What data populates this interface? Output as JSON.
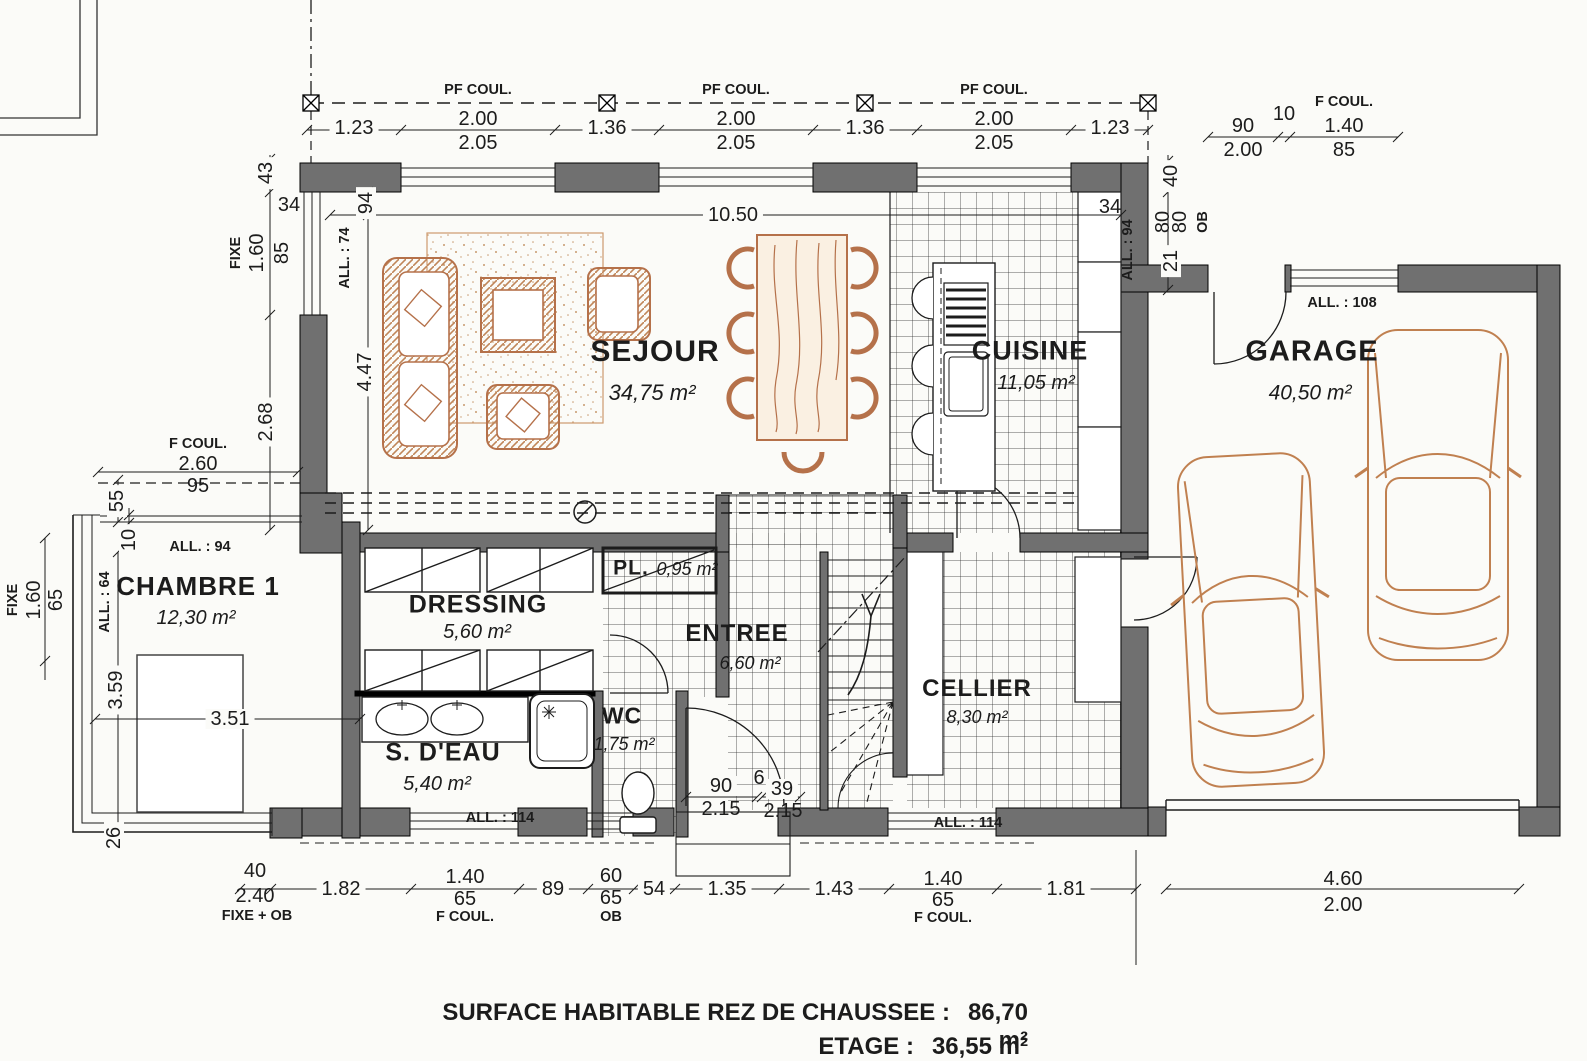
{
  "rooms": {
    "sejour": {
      "name": "SEJOUR",
      "area": "34,75 m²"
    },
    "cuisine": {
      "name": "CUISINE",
      "area": "11,05 m²"
    },
    "garage": {
      "name": "GARAGE",
      "area": "40,50 m²"
    },
    "chambre1": {
      "name": "CHAMBRE 1",
      "area": "12,30 m²"
    },
    "dressing": {
      "name": "DRESSING",
      "area": "5,60 m²"
    },
    "sdeau": {
      "name": "S. D'EAU",
      "area": "5,40 m²"
    },
    "wc": {
      "name": "WC",
      "area": "1,75 m²"
    },
    "entree": {
      "name": "ENTREE",
      "area": "6,60 m²"
    },
    "cellier": {
      "name": "CELLIER",
      "area": "8,30 m²"
    },
    "pl": {
      "name": "PL.",
      "area": "0,95 m²"
    }
  },
  "labels": {
    "pf_coul": "PF COUL.",
    "f_coul": "F COUL.",
    "fixe": "FIXE",
    "fixe_ob": "FIXE + OB",
    "ob": "OB",
    "all64": "ALL. : 64",
    "all74": "ALL. : 74",
    "all94": "ALL. : 94",
    "all108": "ALL. : 108",
    "all114": "ALL. : 114"
  },
  "dims": {
    "t_123a": "1.23",
    "t_200a": "2.00",
    "t_205a": "2.05",
    "t_136a": "1.36",
    "t_200b": "2.00",
    "t_205b": "2.05",
    "t_136b": "1.36",
    "t_200c": "2.00",
    "t_205c": "2.05",
    "t_123b": "1.23",
    "g_90": "90",
    "g_200": "2.00",
    "g_10": "10",
    "g_140": "1.40",
    "g_85": "85",
    "r_40": "40",
    "r_80a": "80",
    "r_80b": "80",
    "r_21": "21",
    "k_34": "34",
    "l_43": "43",
    "l_34": "34",
    "l_160": "1.60",
    "l_85": "85",
    "l_268": "2.68",
    "i_94": "94",
    "i_447": "4.47",
    "i_1050": "10.50",
    "fc_260": "2.60",
    "fc_95": "95",
    "c_55": "55",
    "c_10": "10",
    "c_160": "1.60",
    "c_65": "65",
    "c_359": "3.59",
    "c_351": "3.51",
    "c_26": "26",
    "p_90": "90",
    "p_6": "6",
    "p_39": "39",
    "p_215a": "2.15",
    "p_215b": "2.15",
    "b_40": "40",
    "b_240": "2.40",
    "b_182": "1.82",
    "b_140a": "1.40",
    "b_65a": "65",
    "b_89": "89",
    "b_60": "60",
    "b_65b": "65",
    "b_54": "54",
    "b_135": "1.35",
    "b_143": "1.43",
    "b_140b": "1.40",
    "b_65c": "65",
    "b_181": "1.81",
    "b_460": "4.60",
    "b_200": "2.00"
  },
  "footer": {
    "line1_label": "SURFACE HABITABLE REZ DE CHAUSSEE :",
    "line1_value": "86,70 m²",
    "line2_label": "ETAGE :",
    "line2_value": "36,55 m²"
  }
}
